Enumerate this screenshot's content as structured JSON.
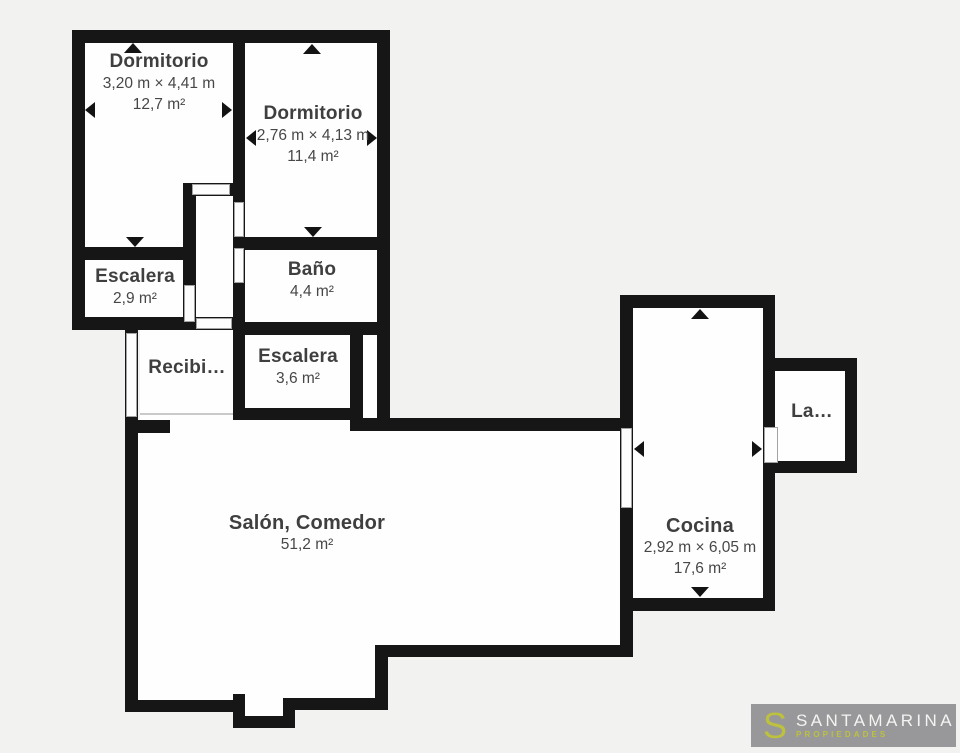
{
  "plan": {
    "background": "#f2f2f1",
    "wall_color": "#161616",
    "floor_color": "#fefefe",
    "rooms": [
      {
        "name": "Dormitorio",
        "dims": "3,20 m × 4,41 m",
        "area": "12,7 m²"
      },
      {
        "name": "Dormitorio",
        "dims": "2,76 m × 4,13 m",
        "area": "11,4 m²"
      },
      {
        "name": "Escalera",
        "area": "2,9 m²"
      },
      {
        "name": "Baño",
        "area": "4,4 m²"
      },
      {
        "name": "Escalera",
        "area": "3,6 m²"
      },
      {
        "name": "Recibi…"
      },
      {
        "name": "Salón, Comedor",
        "area": "51,2 m²"
      },
      {
        "name": "Cocina",
        "dims": "2,92 m × 6,05 m",
        "area": "17,6 m²"
      },
      {
        "name": "La…"
      }
    ]
  },
  "logo": {
    "initial": "S",
    "brand": "SANTAMARINA",
    "tagline": "PROPIEDADES",
    "bg_color": "#98989a",
    "accent_color": "#bdc13d",
    "brand_color": "#f4f4f2"
  }
}
